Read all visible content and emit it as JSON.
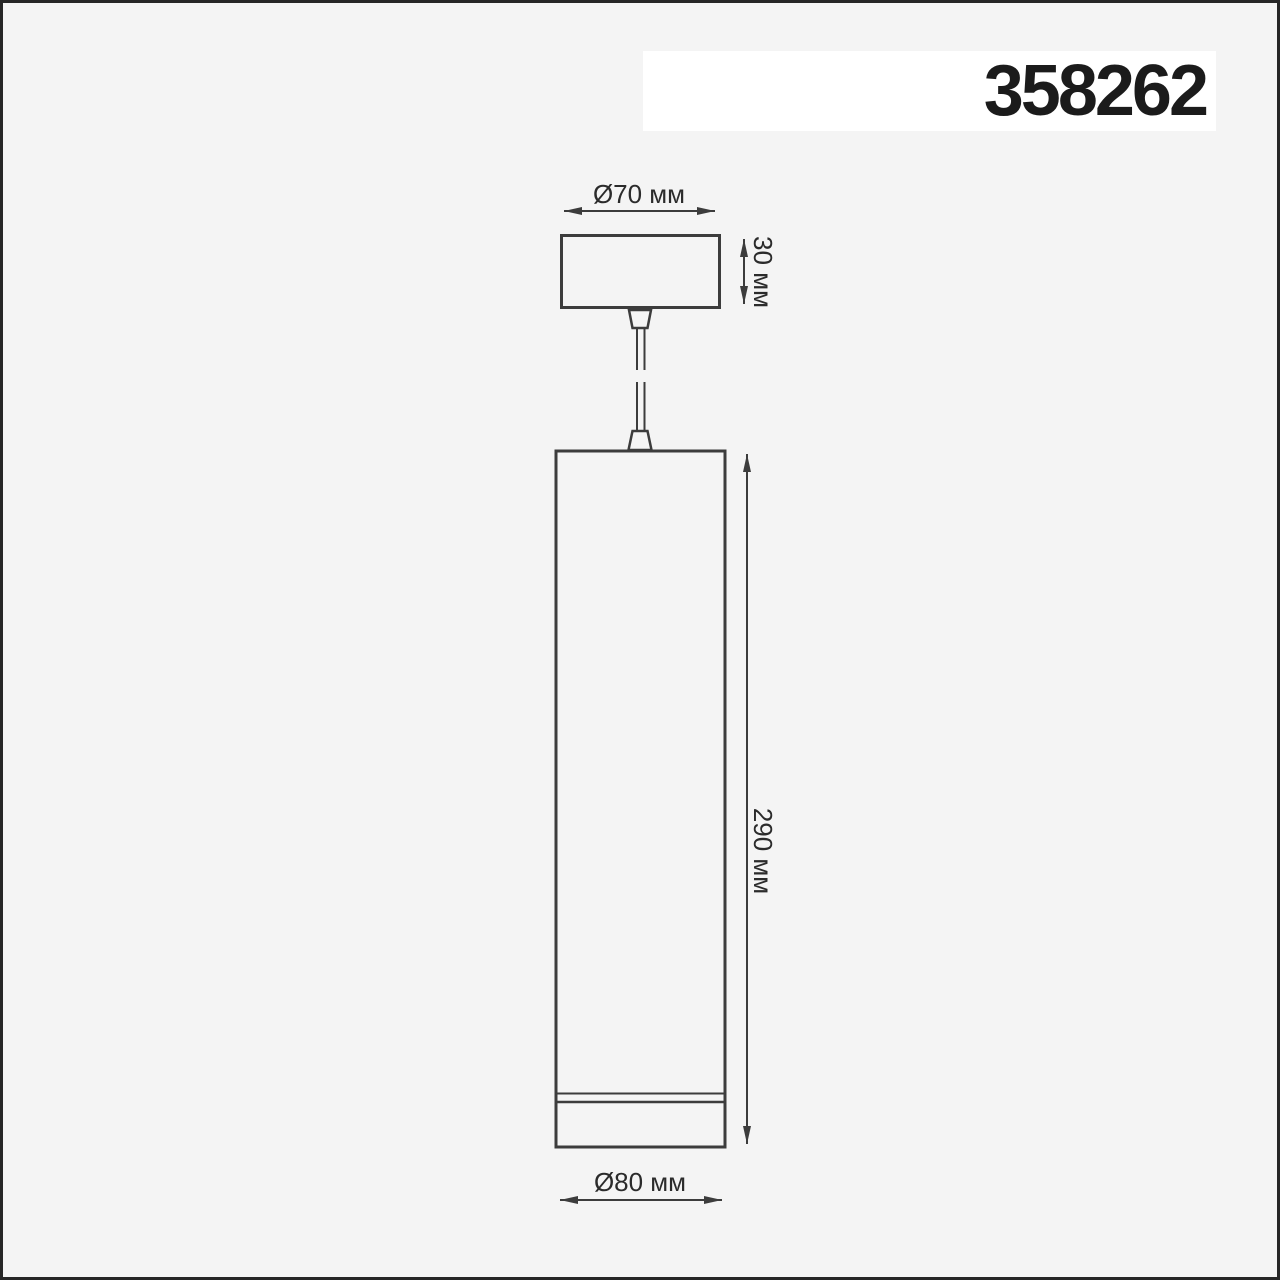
{
  "header": {
    "product_number": "358262"
  },
  "drawing": {
    "type": "technical-dimension-drawing",
    "subject": "suspended cylinder pendant luminaire",
    "labels": {
      "canopy_diameter": "Ø70 мм",
      "canopy_height": "30 мм",
      "body_height": "290 мм",
      "body_diameter": "Ø80 мм"
    },
    "colors": {
      "background": "#f4f4f4",
      "frame_border": "#262626",
      "line": "#3c3c3c",
      "text": "#2b2b2b",
      "header_box": "#ffffff",
      "number_text": "#1b1b1b"
    }
  }
}
